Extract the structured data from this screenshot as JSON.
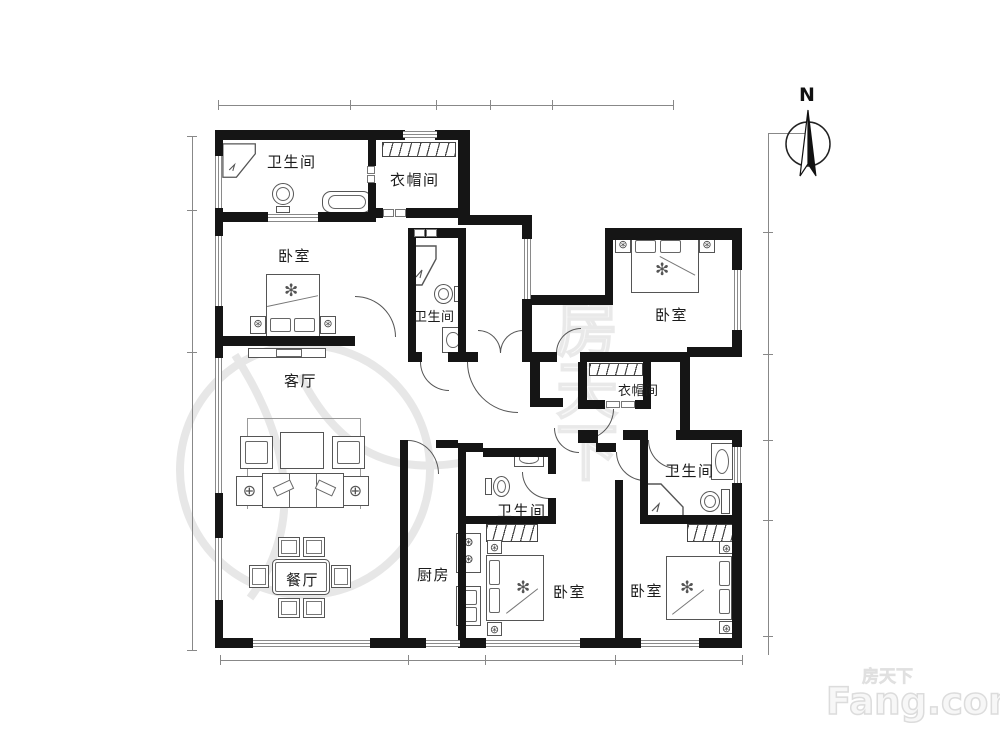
{
  "page": {
    "type": "apartment-floor-plan"
  },
  "rooms": [
    {
      "id": "bath-nw",
      "label": "卫生间"
    },
    {
      "id": "cloak-n",
      "label": "衣帽间"
    },
    {
      "id": "bedroom-w",
      "label": "卧室"
    },
    {
      "id": "bath-mid",
      "label": "卫生间"
    },
    {
      "id": "bedroom-ne",
      "label": "卧室"
    },
    {
      "id": "living",
      "label": "客厅"
    },
    {
      "id": "cloak-e",
      "label": "衣帽间"
    },
    {
      "id": "bath-e",
      "label": "卫生间"
    },
    {
      "id": "bath-s",
      "label": "卫生间"
    },
    {
      "id": "dining",
      "label": "餐厅"
    },
    {
      "id": "kitchen",
      "label": "厨房"
    },
    {
      "id": "bedroom-s",
      "label": "卧室"
    },
    {
      "id": "bedroom-se",
      "label": "卧室"
    }
  ],
  "compass": {
    "north_label": "N"
  },
  "watermark": {
    "site_cn": "房天下",
    "site_en": "Fang.com",
    "center_cn": "房天下"
  },
  "icons": {
    "nightstand": "⊛",
    "side_table": "⊕",
    "bed_decor": "✻",
    "burner": "⊛"
  },
  "colors": {
    "wall": "#151515",
    "line": "#555555",
    "dimension": "#888888",
    "watermark": "#e6e6e6"
  }
}
